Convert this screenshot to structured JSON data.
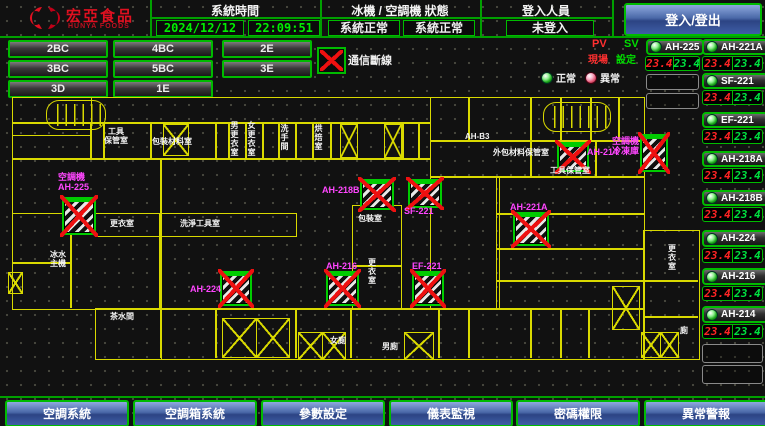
{
  "header": {
    "logo_cn": "宏亞食品",
    "logo_en": "HUNYA FOODS",
    "time_label": "系統時間",
    "date": "2024/12/12",
    "time": "22:09:51",
    "status_label": "冰機 / 空調機 狀態",
    "chiller_status": "系統正常",
    "ahu_status": "系統正常",
    "login_label": "登入人員",
    "login_value": "未登入",
    "login_button": "登入/登出"
  },
  "floors": [
    "2BC",
    "4BC",
    "2E",
    "3BC",
    "5BC",
    "3E",
    "3D",
    "1E"
  ],
  "legend": {
    "comm_error": "通信斷線",
    "normal": "正常",
    "abnormal": "異常",
    "pv": "PV",
    "sv": "SV",
    "pv_label": "現場",
    "sv_label": "設定"
  },
  "colors": {
    "accent_green": "#00bb00",
    "wall_yellow": "#d9d900",
    "alarm_red": "#ee1010",
    "label_magenta": "#ff46ff",
    "pv_red": "#ff2424",
    "sv_green": "#00e040"
  },
  "equipment_panel": {
    "units": [
      {
        "name": "AH-225",
        "pv": "23.4",
        "sv": "23.4"
      },
      {
        "name": "AH-221A",
        "pv": "23.4",
        "sv": "23.4"
      },
      {
        "name": "SF-221",
        "pv": "23.4",
        "sv": "23.4"
      },
      {
        "name": "EF-221",
        "pv": "23.4",
        "sv": "23.4"
      },
      {
        "name": "AH-218A",
        "pv": "23.4",
        "sv": "23.4"
      },
      {
        "name": "AH-218B",
        "pv": "23.4",
        "sv": "23.4"
      },
      {
        "name": "AH-224",
        "pv": "23.4",
        "sv": "23.4"
      },
      {
        "name": "AH-216",
        "pv": "23.4",
        "sv": "23.4"
      },
      {
        "name": "AH-214",
        "pv": "23.4",
        "sv": "23.4"
      }
    ]
  },
  "floorplan": {
    "devices": [
      {
        "label": "空調機\nAH-225"
      },
      {
        "label": "AH-218B"
      },
      {
        "label": "SF-221"
      },
      {
        "label": "AH-214"
      },
      {
        "label": "空調機\n冷凍庫"
      },
      {
        "label": "AH-221A"
      },
      {
        "label": "AH-224"
      },
      {
        "label": "AH-216"
      },
      {
        "label": "EF-221"
      }
    ],
    "rooms": [
      {
        "t": "工具\n保管室"
      },
      {
        "t": "包裝材料室"
      },
      {
        "t": "男更衣室"
      },
      {
        "t": "女更衣室"
      },
      {
        "t": "洗手間"
      },
      {
        "t": "烘焙室"
      },
      {
        "t": "AH-B3"
      },
      {
        "t": "外包材料保管室"
      },
      {
        "t": "工具保管室"
      },
      {
        "t": "冰水\n主機"
      },
      {
        "t": "更衣室"
      },
      {
        "t": "洗淨工具室"
      },
      {
        "t": "包裝室"
      },
      {
        "t": "更\n衣\n室"
      },
      {
        "t": "茶水間"
      },
      {
        "t": "女廁"
      },
      {
        "t": "男廁"
      },
      {
        "t": "更\n衣\n室"
      },
      {
        "t": "廁"
      }
    ]
  },
  "nav": [
    "空調系統",
    "空調箱系統",
    "參數設定",
    "儀表監視",
    "密碼權限",
    "異常警報"
  ]
}
